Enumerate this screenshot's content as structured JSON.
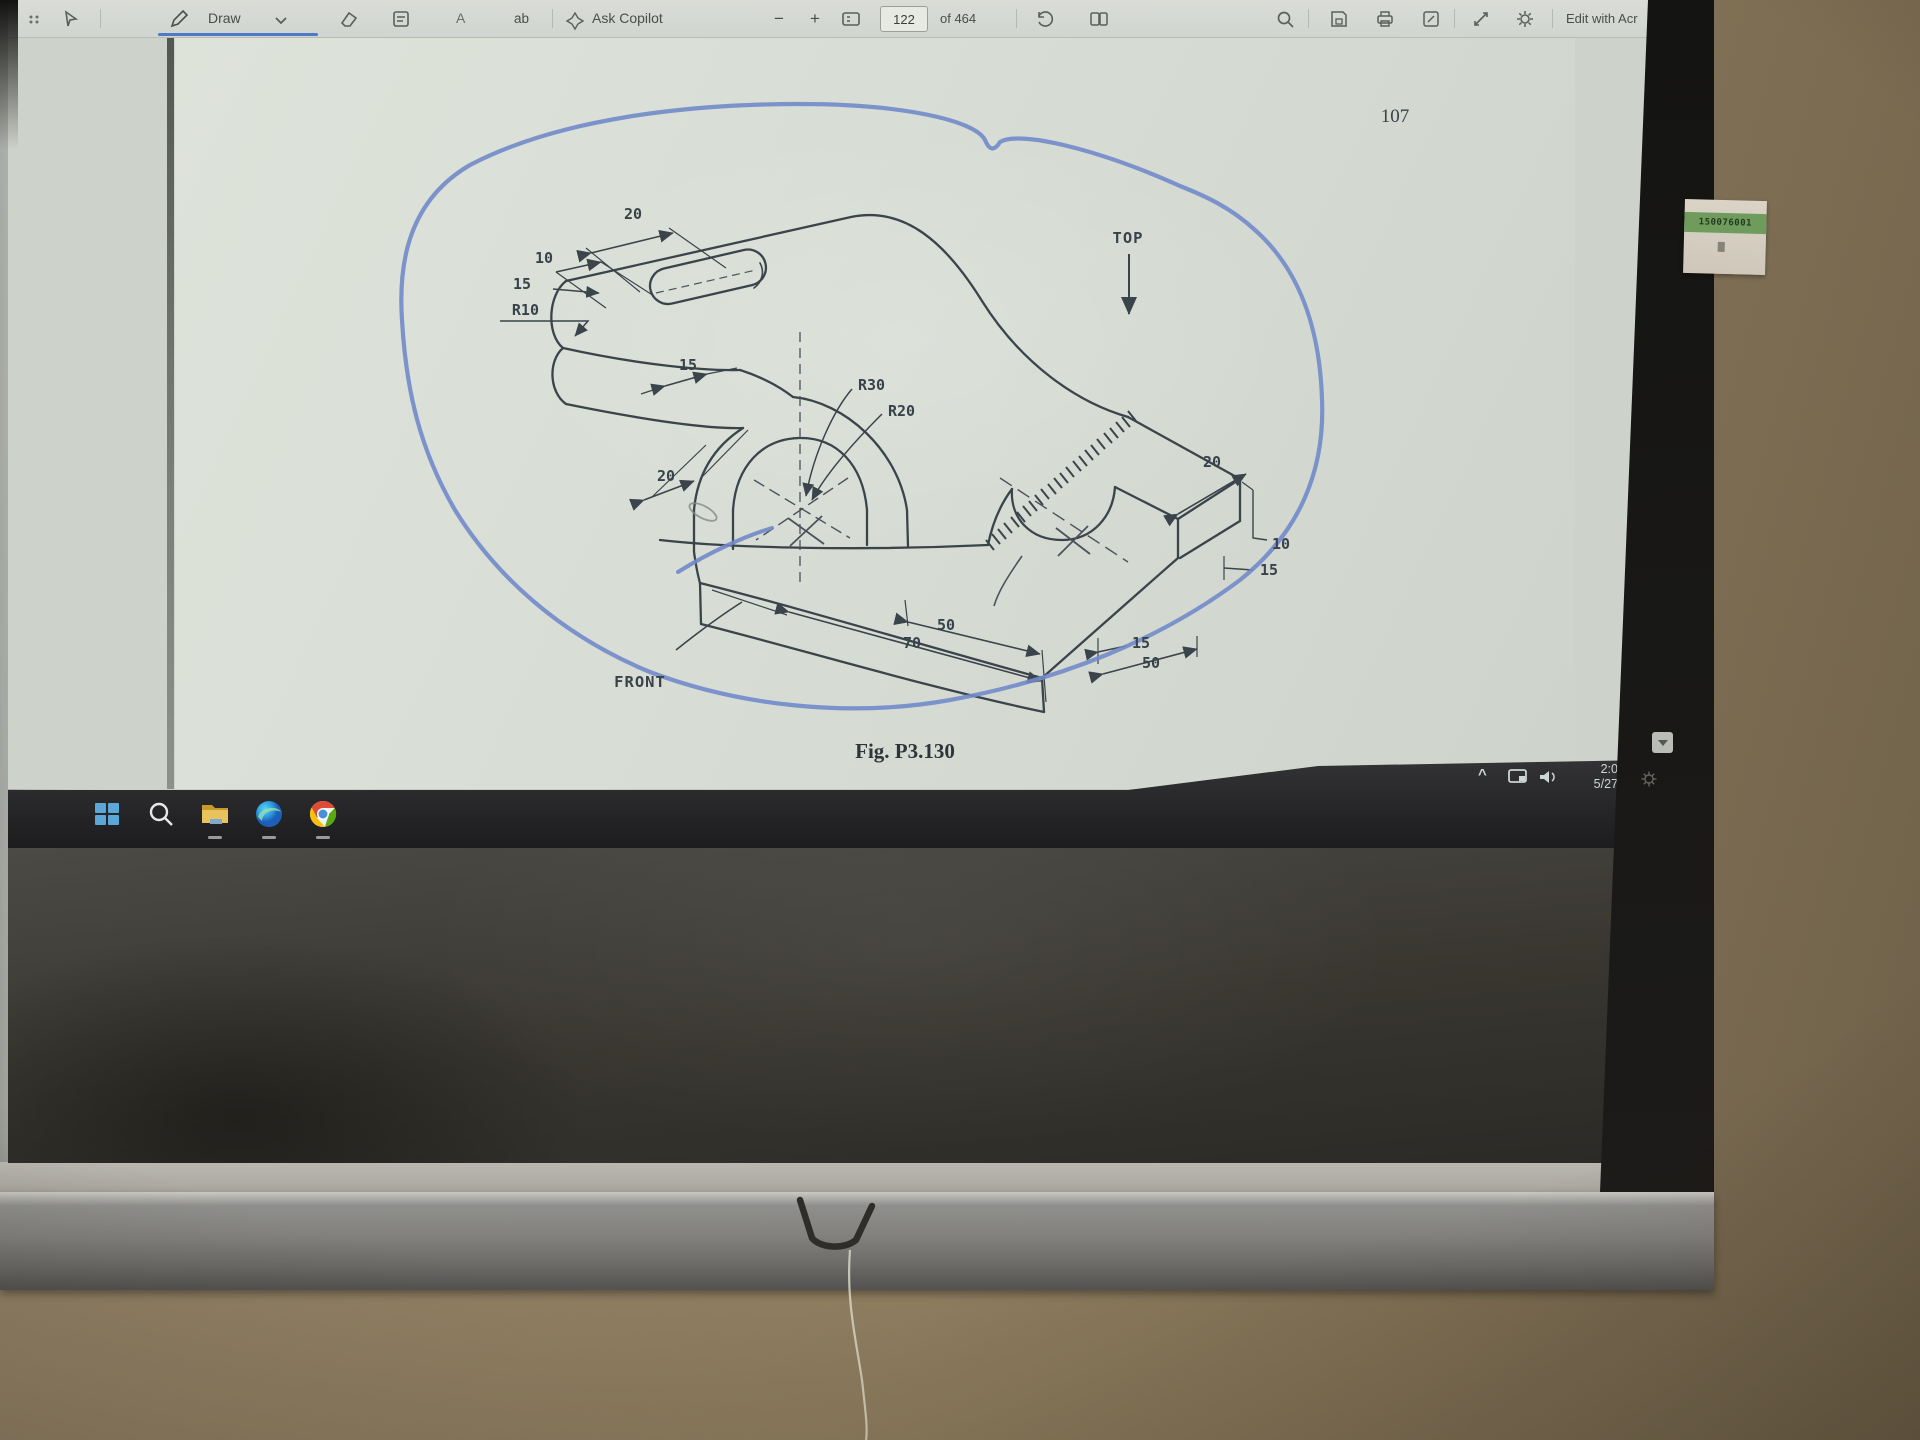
{
  "toolbar": {
    "draw_label": "Draw",
    "add_text_label": "A",
    "read_aloud_label": "ab",
    "ask_copilot_label": "Ask Copilot",
    "zoom_out_glyph": "−",
    "zoom_in_glyph": "+",
    "page_input_value": "122",
    "page_count_label": "of 464",
    "edit_with_label": "Edit with Acr",
    "accent_underline_color": "#4e79c7"
  },
  "pdf_page": {
    "page_number": "107",
    "figure_caption": "Fig. P3.130",
    "annotation_color": "#7189c9",
    "drawing": {
      "view_labels": {
        "top": "TOP",
        "front": "FRONT"
      },
      "dimensions": {
        "slot_length": "20",
        "slot_width": "10",
        "edge_offset": "15",
        "end_radius": "R10",
        "arm_width": "15",
        "base_width": "20",
        "outer_radius": "R30",
        "inner_radius": "R20",
        "fork_top_length": "20",
        "step_height": "10",
        "step_depth": "15",
        "upper_length": "50",
        "lower_length": "70",
        "notch_width": "15",
        "fork_length": "50"
      }
    }
  },
  "taskbar": {
    "icons": [
      {
        "name": "start",
        "color": "#5ba7d7"
      },
      {
        "name": "search",
        "color": "#e8e8e6"
      },
      {
        "name": "file-explorer",
        "color": "#dfae3f"
      },
      {
        "name": "edge",
        "color": "#2f9be0"
      },
      {
        "name": "chrome",
        "color": "#dd4b39"
      }
    ]
  },
  "system_tray": {
    "time": "2:0",
    "date": "5/27"
  },
  "wall": {
    "sticker_digits": "150076001"
  }
}
